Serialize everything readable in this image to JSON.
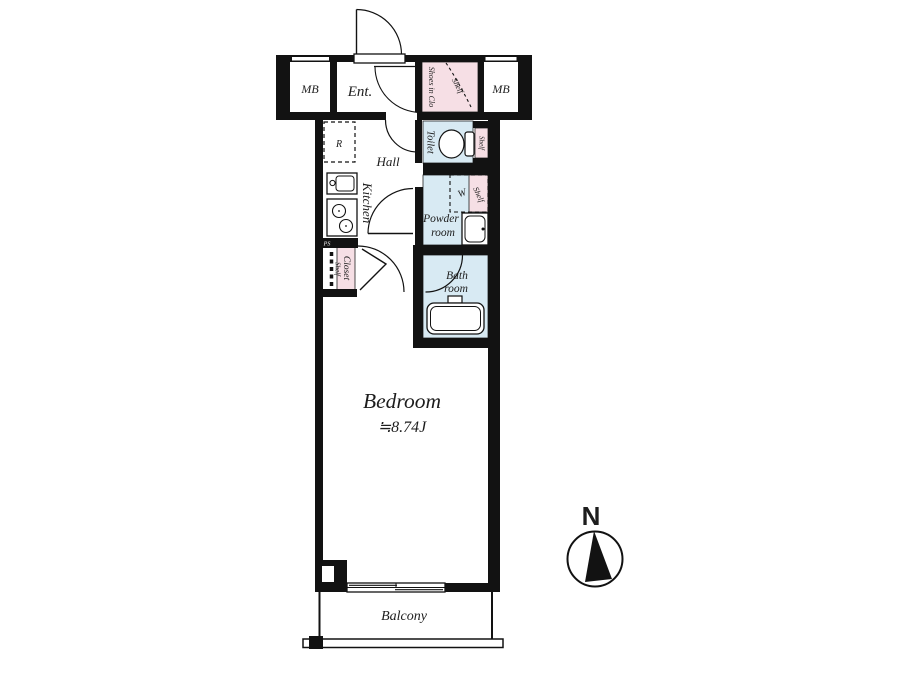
{
  "colors": {
    "wall": "#121212",
    "closet_pink": "#f6dfe5",
    "wet_area_blue": "#d8eaf3",
    "floor_white": "#ffffff"
  },
  "floorplan": {
    "meter_box_left": "MB",
    "meter_box_right": "MB",
    "entrance": "Ent.",
    "shoe_closet": "Shoes in Clo",
    "shoe_closet_shelf": "Shelf",
    "refrigerator_space": "R",
    "hall": "Hall",
    "kitchen": "Kitchen",
    "toilet": "Toilet",
    "toilet_shelf": "Shelf",
    "powder_room_line1": "Powder",
    "powder_room_line2": "room",
    "washer_space": "W",
    "powder_shelf": "Shelf",
    "pipe_space": "PS",
    "closet": "Closet",
    "closet_shelf": "Shelf",
    "bath_line1": "Bath",
    "bath_line2": "room",
    "bedroom": "Bedroom",
    "bedroom_area": "≒8.74J",
    "balcony": "Balcony"
  },
  "compass": {
    "north": "N"
  }
}
